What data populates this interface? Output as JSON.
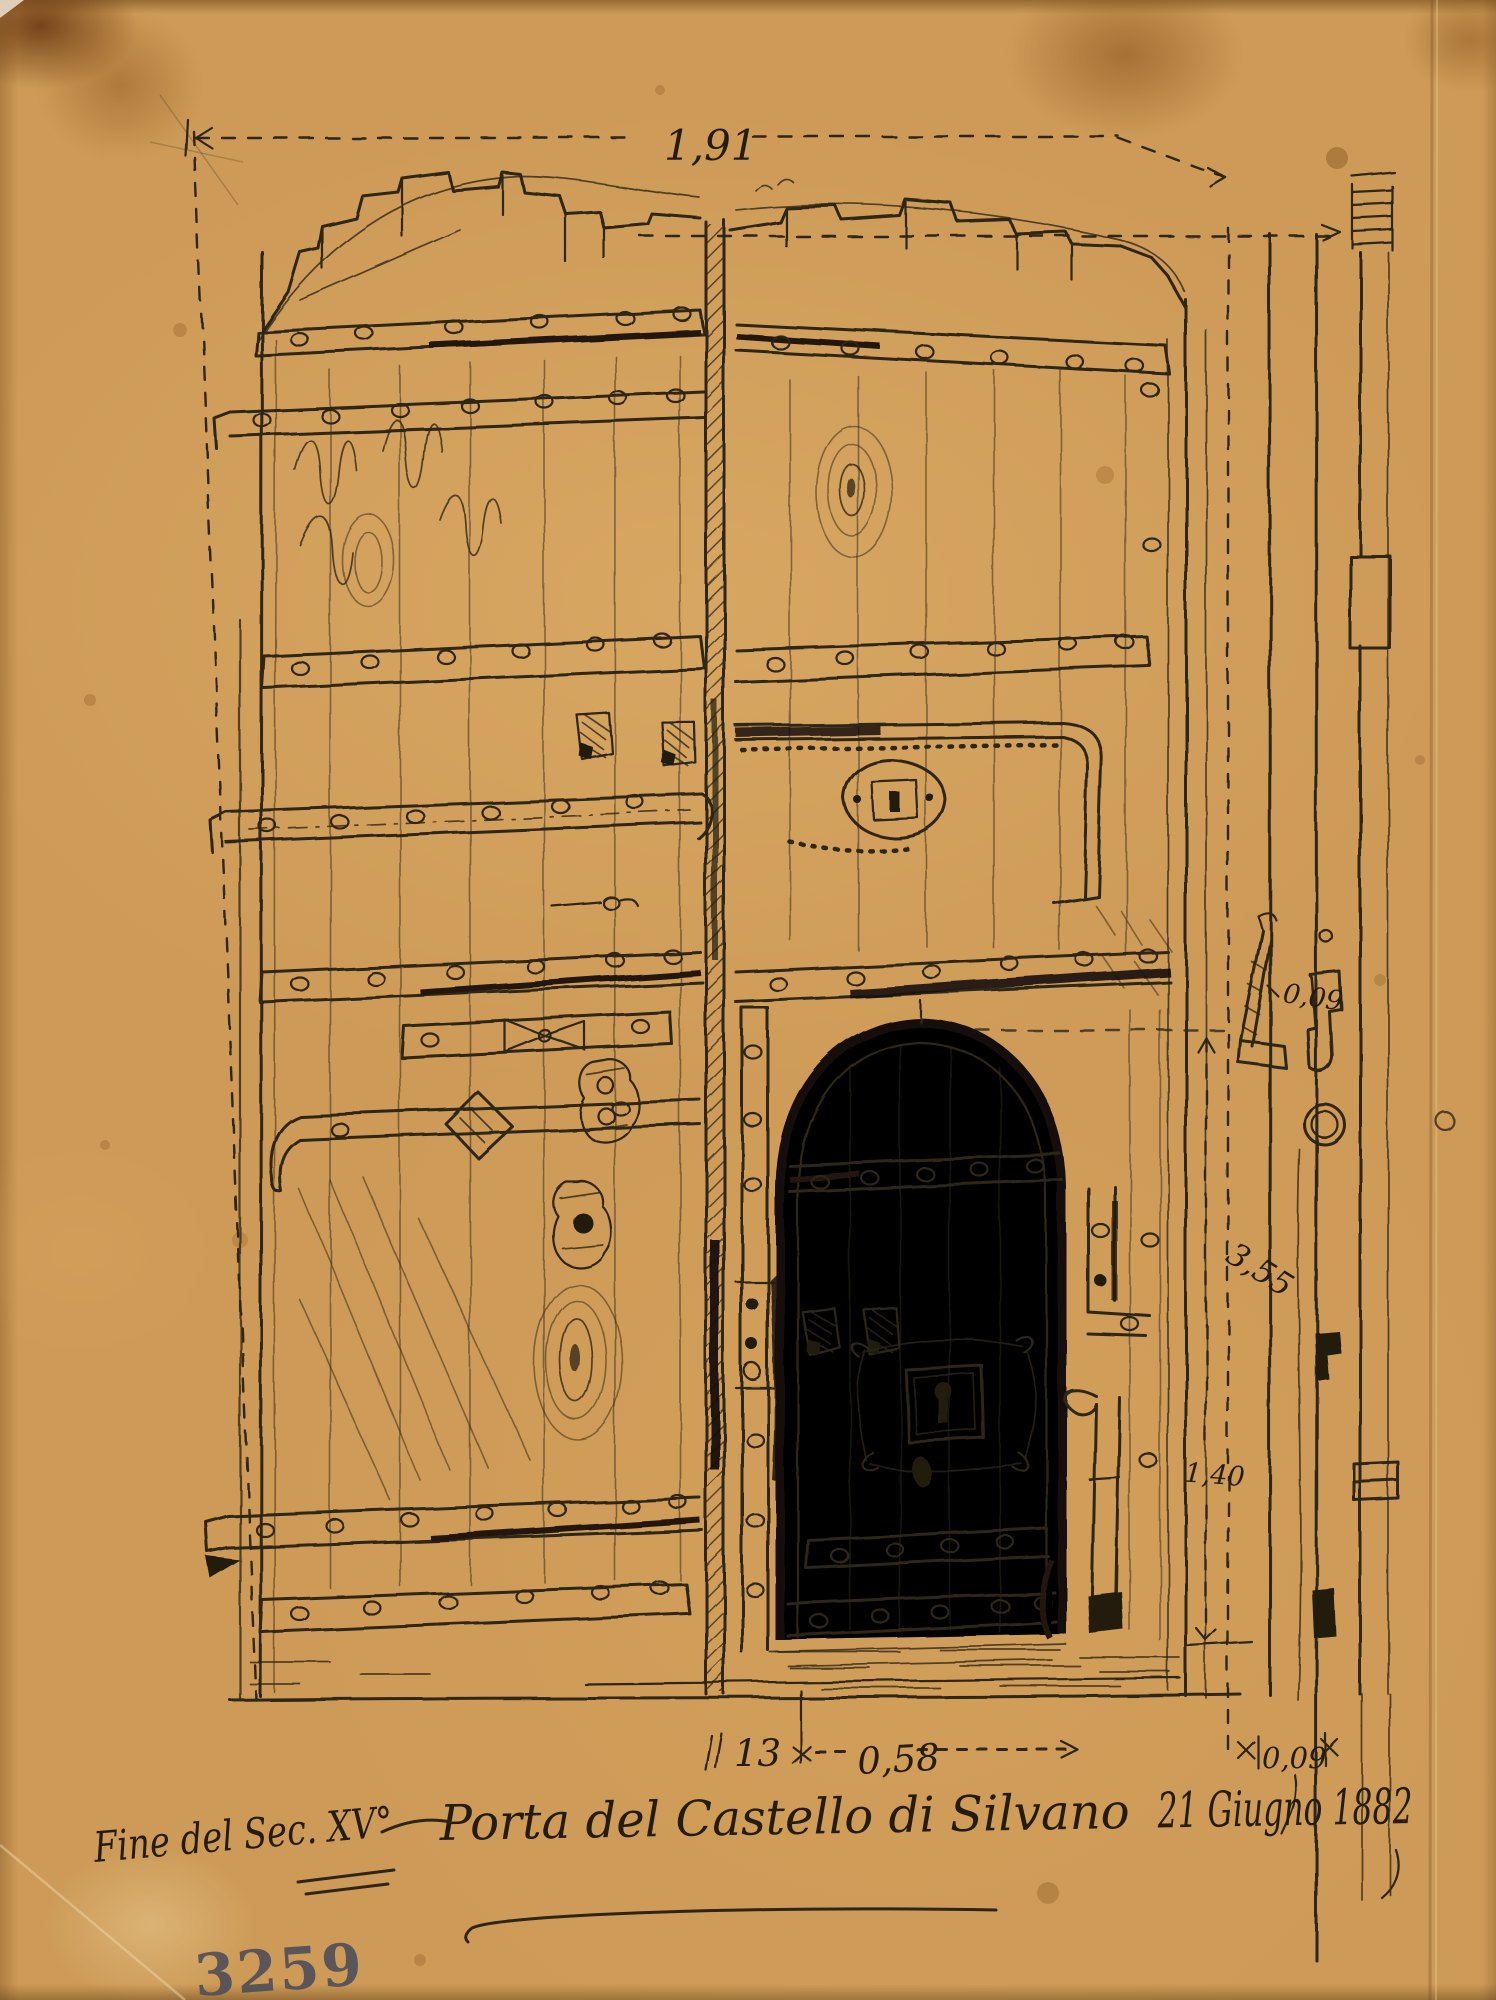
{
  "sheet": {
    "inventory_number": "3259",
    "period_note": "Fine del Sec. XV°",
    "title": "Porta del Castello di Silvano",
    "date": "21 Giugno 1882"
  },
  "measurements": {
    "overall_width": "1,91",
    "leaf_thickness": "0,09",
    "overall_height": "3,55",
    "wicket_height": "1,40",
    "center_post_width": "13",
    "wicket_width": "0,58",
    "frame_thickness": "0,09"
  }
}
